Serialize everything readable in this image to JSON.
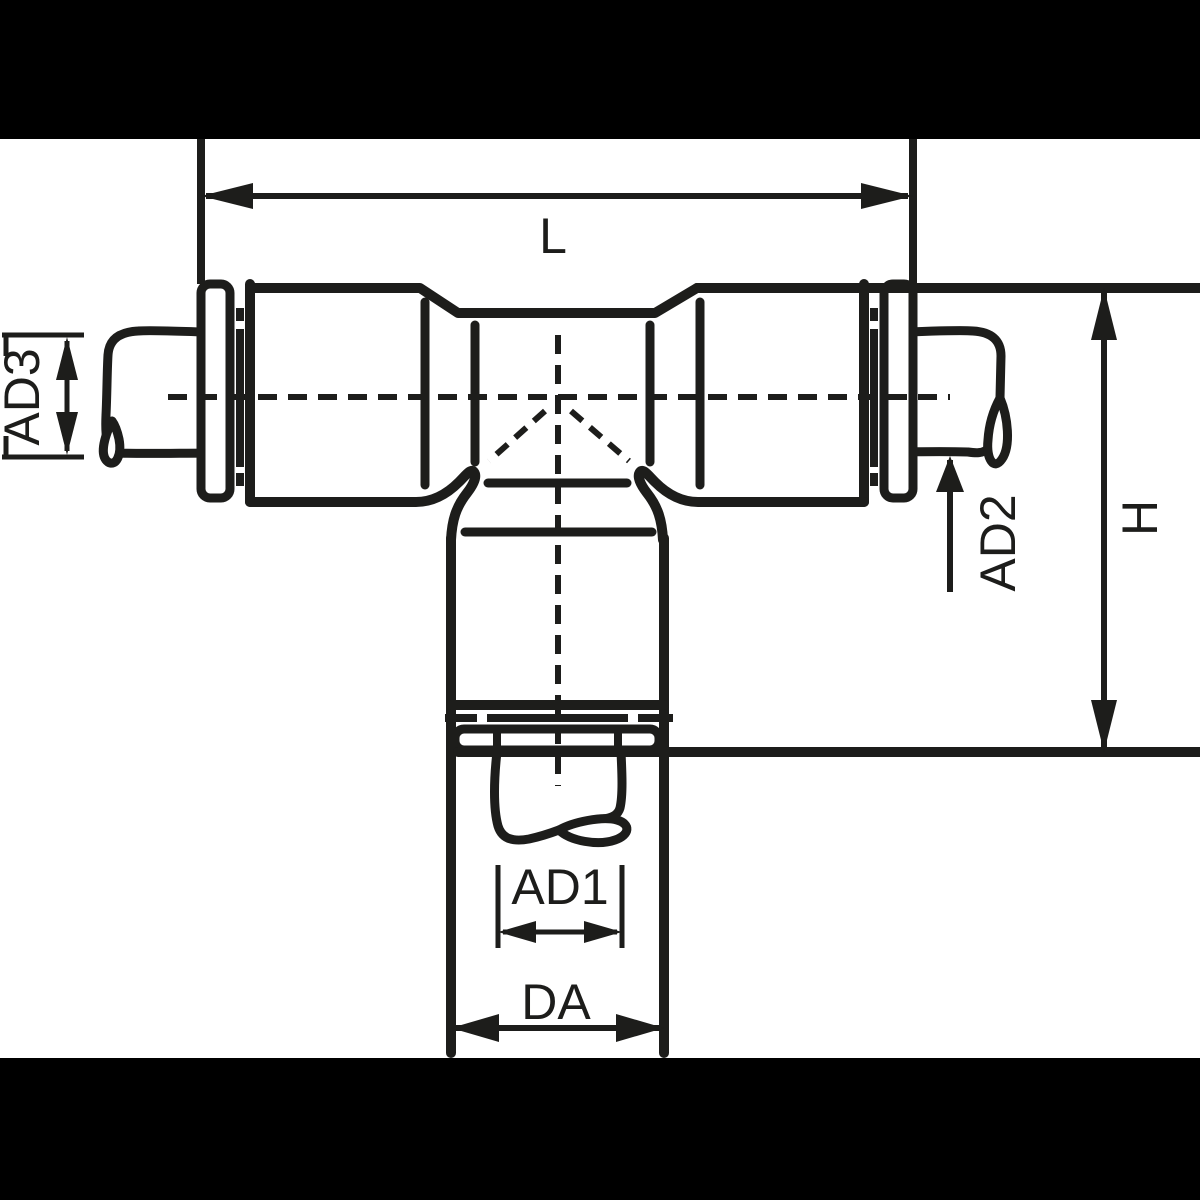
{
  "figure": {
    "title": "Push-in T-fitting dimensioned technical drawing",
    "type": "engineering line drawing",
    "background_color": "#ffffff",
    "line_color": "#1d1d1b",
    "mask_bar_color": "#000000"
  },
  "dimensions": {
    "overall_length": {
      "label": "L"
    },
    "overall_height": {
      "label": "H"
    },
    "bottom_tube_od": {
      "label": "AD1"
    },
    "right_tube_od": {
      "label": "AD2"
    },
    "left_tube_od": {
      "label": "AD3"
    },
    "body_od": {
      "label": "DA"
    }
  }
}
